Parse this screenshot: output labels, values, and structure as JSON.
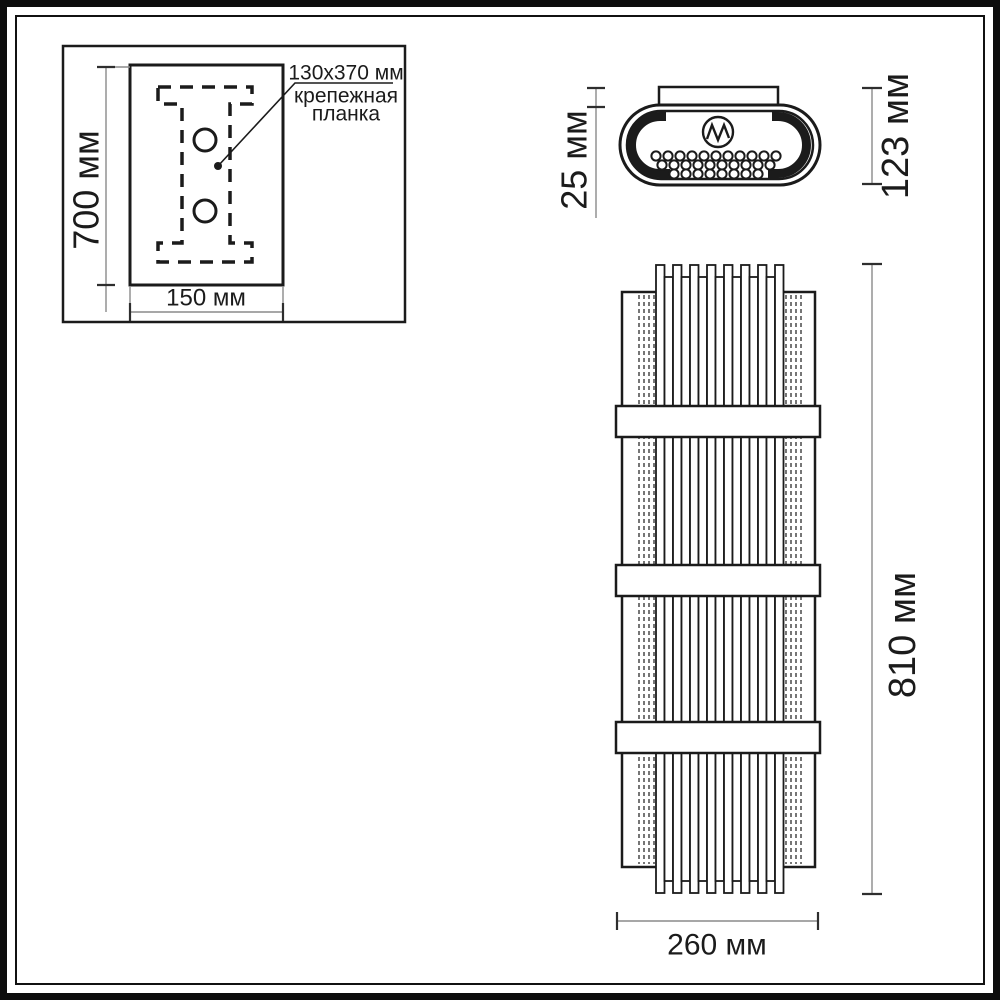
{
  "colors": {
    "line": "#1b1b1b",
    "dim_line": "#8a8a8a",
    "tick": "#2e2e2e",
    "background": "#ffffff"
  },
  "mounting_plate_view": {
    "height_label": "700 мм",
    "width_label": "150 мм",
    "callout": {
      "line1": "130x370 мм",
      "line2": "крепежная",
      "line3": "планка"
    }
  },
  "top_view": {
    "bracket_height_label": "25 мм",
    "total_height_label": "123 мм",
    "dot_rows": [
      11,
      10,
      8
    ]
  },
  "front_view": {
    "height_label": "810 мм",
    "width_label": "260 мм",
    "tall_rod_count": 8,
    "short_rod_count": 7,
    "edge_line_count": 4,
    "band_count": 3
  }
}
